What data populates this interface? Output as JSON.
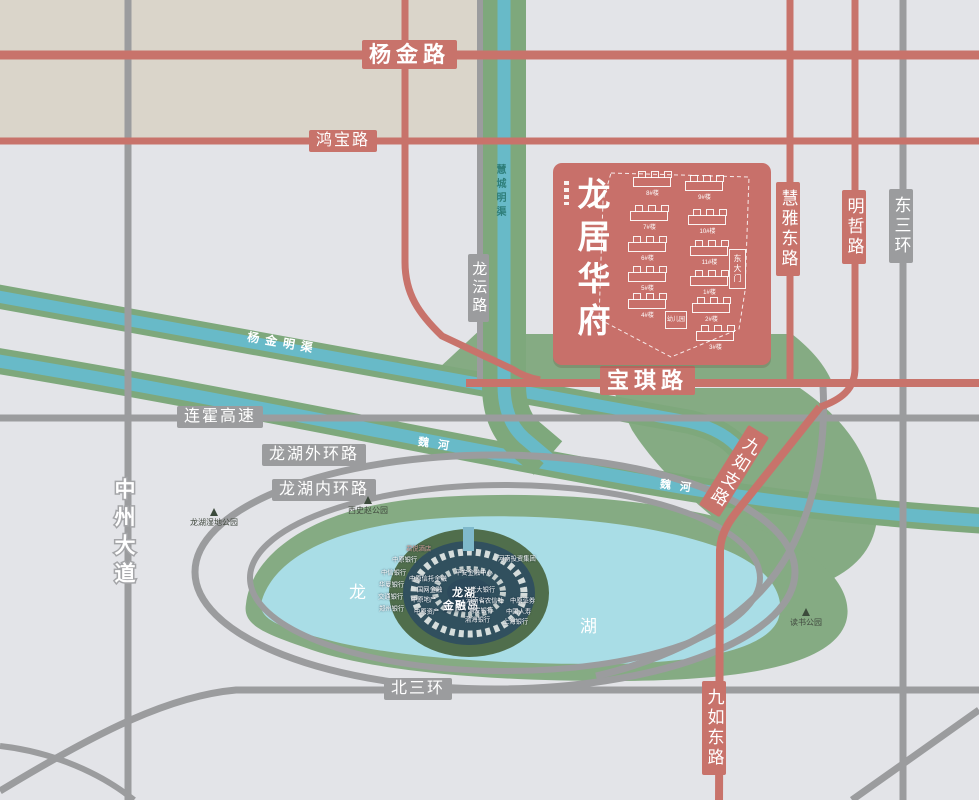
{
  "colors": {
    "road_red": "#c8736b",
    "road_gray": "#9b9c9e",
    "water_blue": "#68bac8",
    "bank_green": "#7ea87c",
    "area_green": "#85ab83",
    "lake_blue": "#a9dde6",
    "beige": "#dad5ca",
    "background": "#e3e4e8",
    "site_red": "#c8706a"
  },
  "roads": {
    "yangjin": "杨金路",
    "hongbao": "鸿宝路",
    "longyun": "龙沄路",
    "baoqi": "宝琪路",
    "lianhuo": "连霍高速",
    "outer_ring": "龙湖外环路",
    "inner_ring": "龙湖内环路",
    "north3": "北三环",
    "zhongzhou": "中州大道",
    "jiuru_branch": "九如支路",
    "jiuru_east": "九如东路",
    "huiya": "慧雅东路",
    "mingzhe": "明哲路",
    "east3": "东三环"
  },
  "water": {
    "huicheng": "慧城明渠",
    "yangjin_canal": "杨金明渠",
    "weihe1": "魏河",
    "weihe2": "魏河"
  },
  "lake": {
    "char1": "龙",
    "char2": "湖"
  },
  "parks": {
    "wetland": "龙湖湿地公园",
    "xishizhao": "西史赵公园",
    "dushu": "读书公园"
  },
  "site": {
    "logo": "龙居华府",
    "gate": "东大门",
    "kindergarten": "幼儿园",
    "buildings": [
      "8#楼",
      "9#楼",
      "7#楼",
      "10#楼",
      "6#楼",
      "11#楼",
      "5#楼",
      "1#楼",
      "4#楼",
      "2#楼",
      "3#楼"
    ]
  },
  "island": {
    "title1": "龙湖",
    "title2": "金融岛",
    "labels": [
      "君悦酒店",
      "中原银行",
      "中信银行",
      "华夏银行",
      "交通银行",
      "郑州银行",
      "中原信托金融",
      "国网金融",
      "中原地产",
      "中原资产",
      "平安金融中心",
      "光大银行",
      "河南省农信社",
      "浦发银行",
      "渤海银行",
      "河南投资集团",
      "中原证券",
      "中国人寿",
      "上海银行"
    ]
  }
}
